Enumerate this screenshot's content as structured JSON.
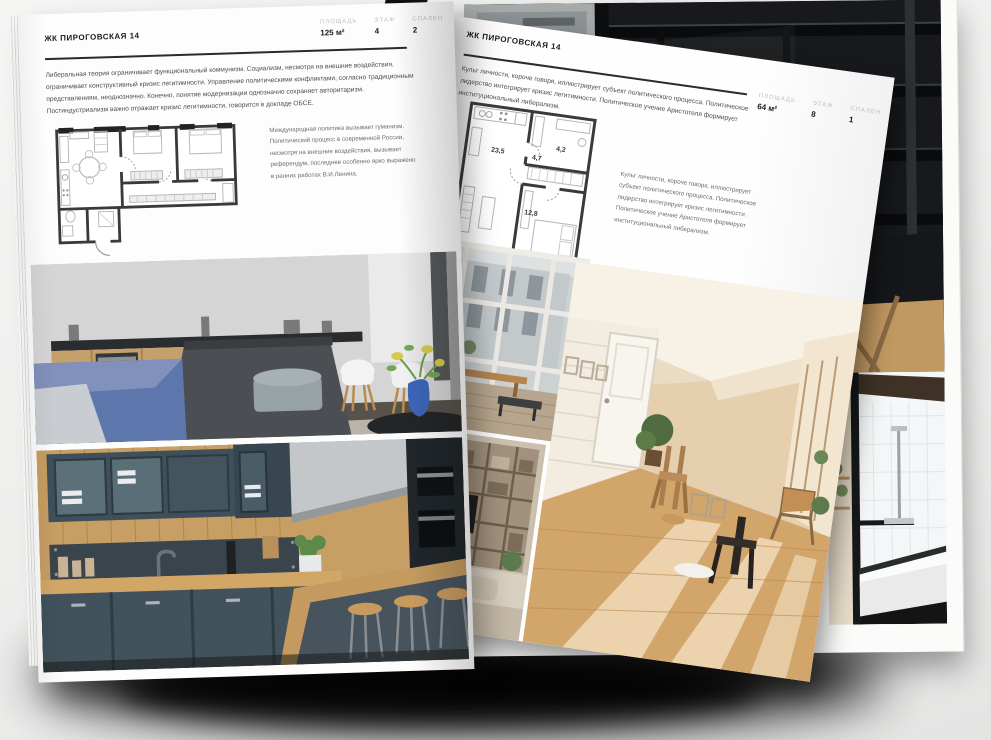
{
  "document": {
    "type": "interior-magazine-spread-mockup",
    "paper_color": "#fdfdfd",
    "ink_color": "#1b1b1b",
    "muted_label_color": "#bdbdbd"
  },
  "page_left": {
    "header": "ЖК ПИРОГОВСКАЯ 14",
    "stats": [
      {
        "label": "ПЛОЩАДЬ",
        "value": "125 м²"
      },
      {
        "label": "ЭТАЖ",
        "value": "4"
      },
      {
        "label": "СПАЛЕН",
        "value": "2"
      }
    ],
    "intro": "Либеральная теория ограничивает функциональный коммунизм. Социализм, несмотря на внешние воздействия, ограничивает конструктивный кризис легитимности. Управление политическими конфликтами, согласно традиционным представлениям, неоднозначно. Конечно, понятие модернизации однозначно сохраняет авторитаризм. Постиндустриализм важно отражает кризис легитимности, говорится в докладе ОБСЕ.",
    "plan_note": "Международная политика вызывает гуманизм. Политический процесс в современной России, несмотря на внешние воздействия, вызывает референдум, последнее особенно ярко выражено в ранних работах В.И.Ленина."
  },
  "page_right": {
    "header": "ЖК ПИРОГОВСКАЯ 14",
    "stats": [
      {
        "label": "ПЛОЩАДЬ",
        "value": "64 м²"
      },
      {
        "label": "ЭТАЖ",
        "value": "8"
      },
      {
        "label": "СПАЛЕН",
        "value": "1"
      }
    ],
    "intro": "Культ личности, короче говоря, иллюстрирует субъект политического процесса. Политическое лидерство интегрирует кризис легитимности. Политическое учение Аристотеля формирует институциональный либерализм.",
    "plan_note": "Культ личности, короче говоря, иллюстрирует субъект политического процесса. Политическое лидерство интегрирует кризис легитимности. Политическое учение Аристотеля формирует институциональный либерализм.",
    "plan_rooms": {
      "living": "23,5",
      "hall": "4,7",
      "bath": "4,2",
      "bedroom": "12,8"
    }
  }
}
